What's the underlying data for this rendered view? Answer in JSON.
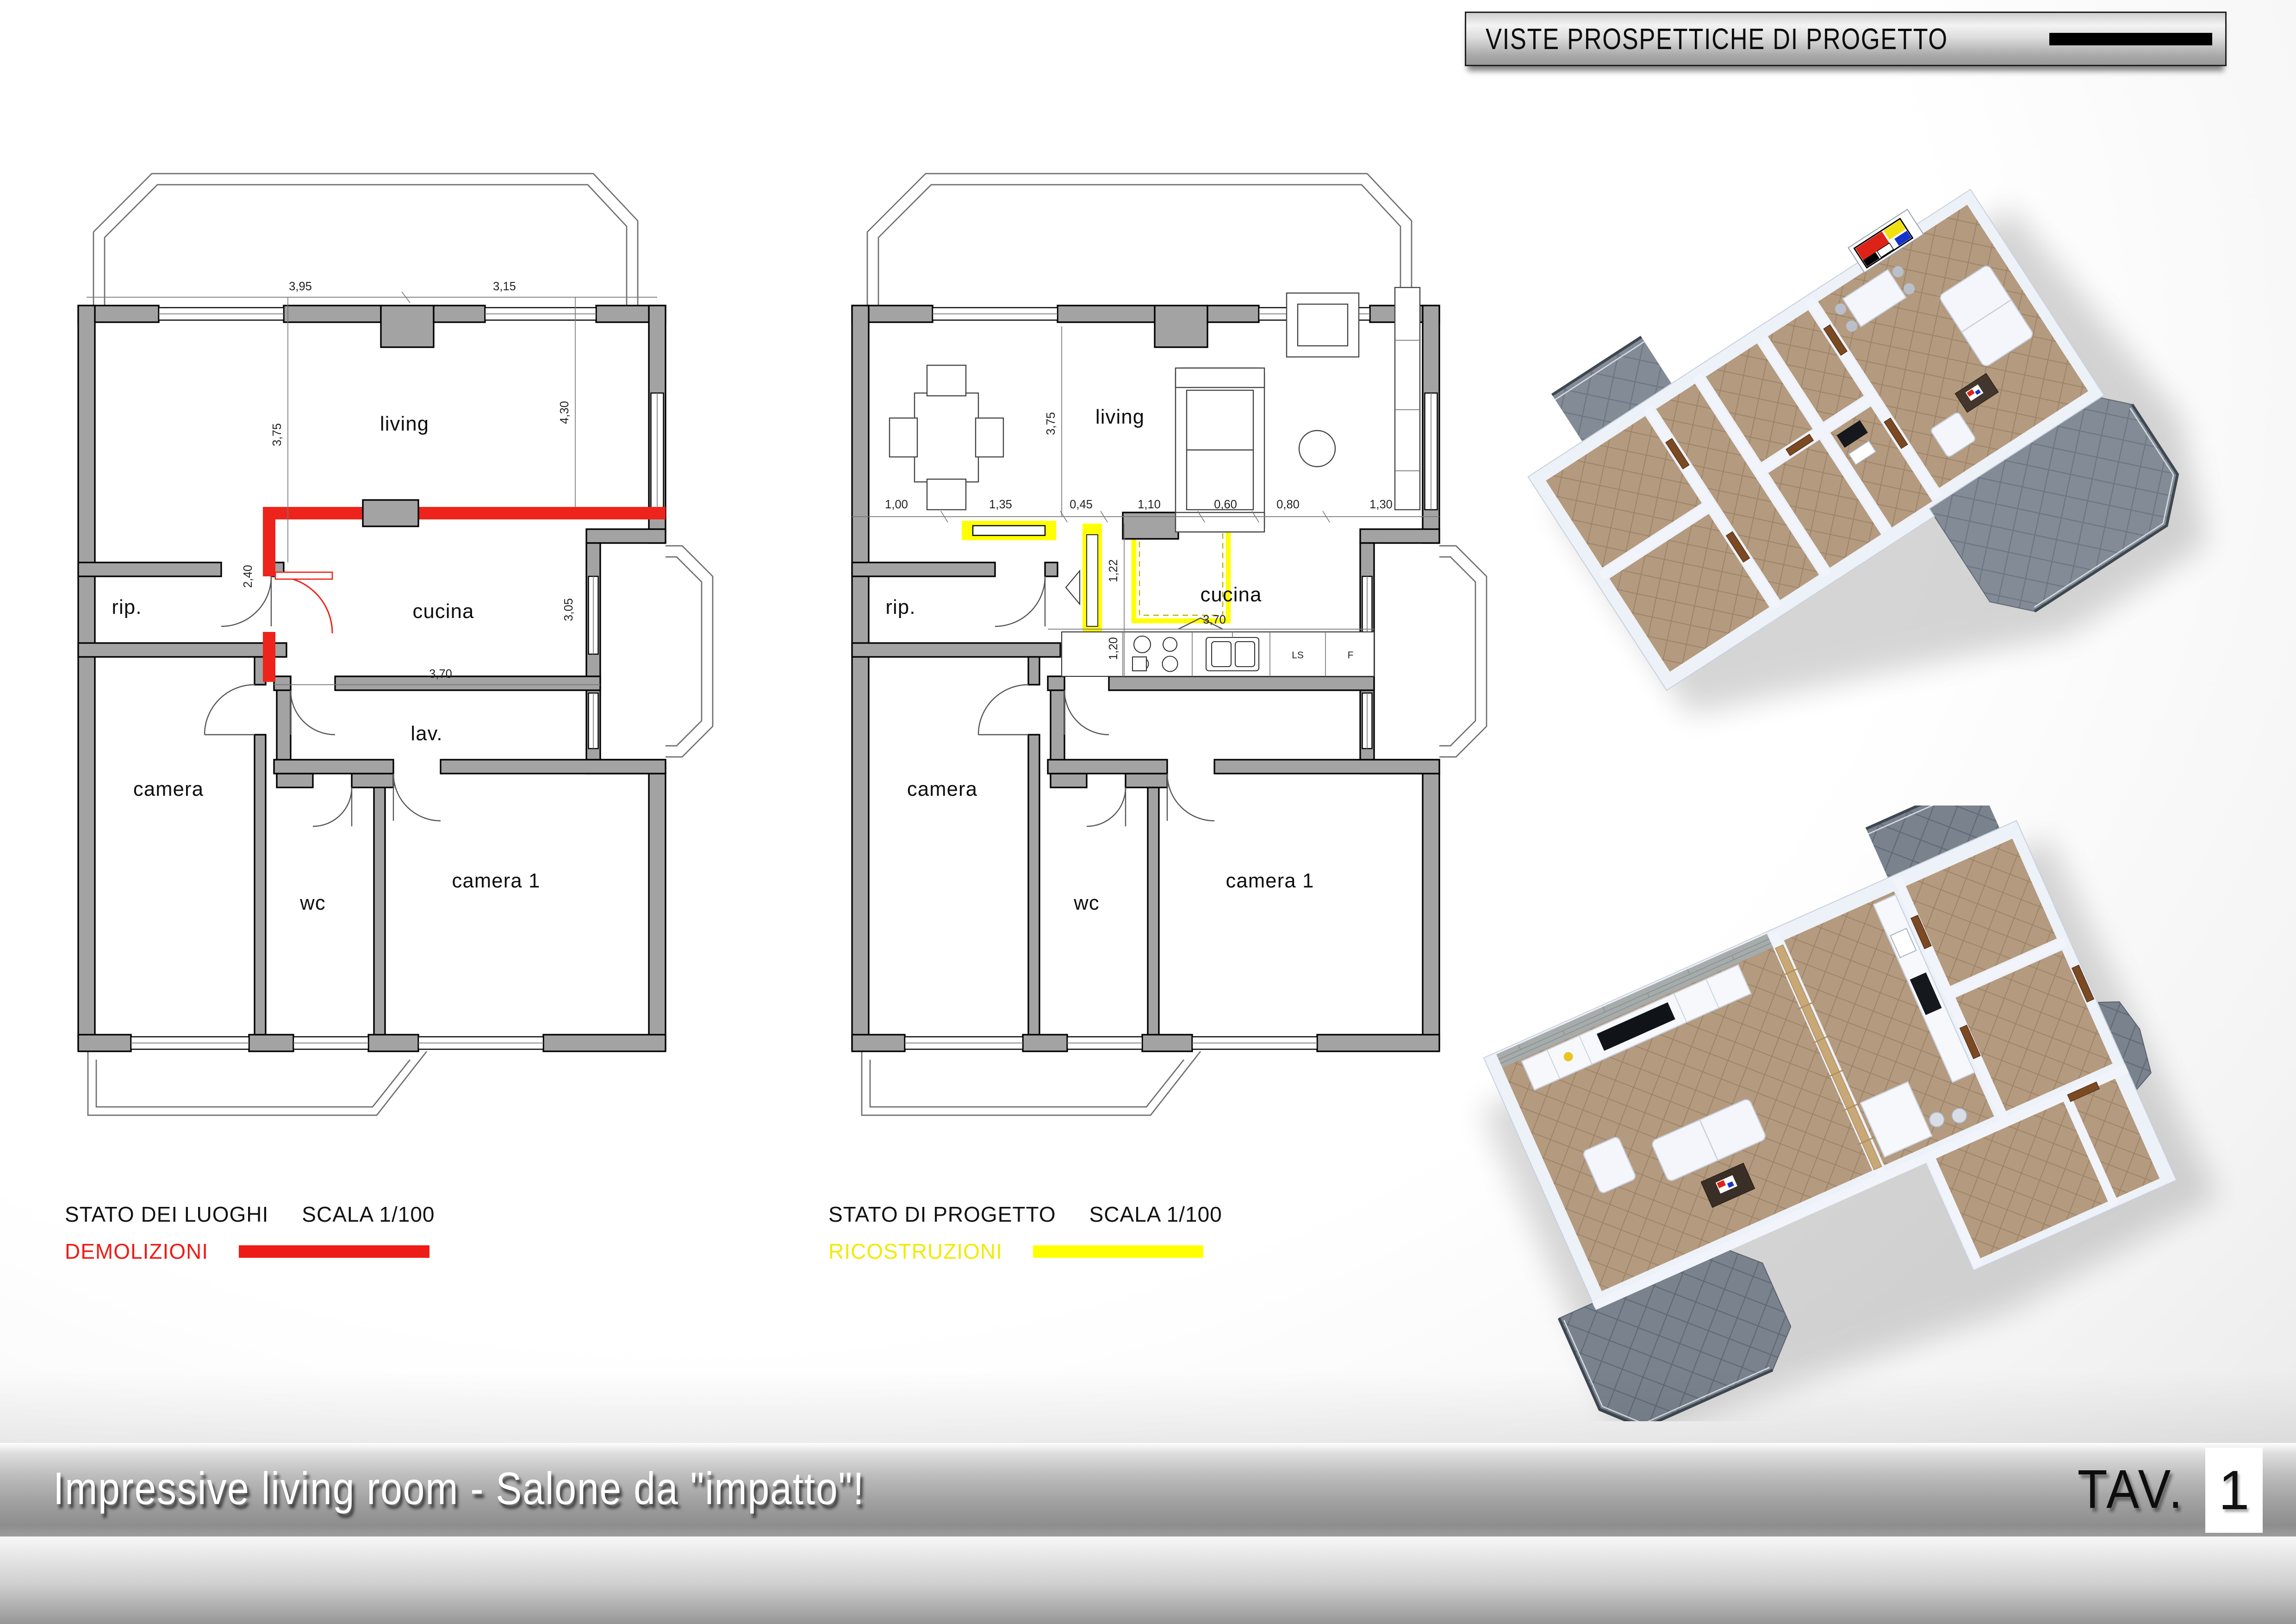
{
  "header": {
    "banner_title": "VISTE PROSPETTICHE DI PROGETTO"
  },
  "plan_left": {
    "rooms": {
      "living": "living",
      "cucina": "cucina",
      "rip": "rip.",
      "camera": "camera",
      "lav": "lav.",
      "wc": "wc",
      "camera1": "camera 1"
    },
    "dims": {
      "top_left": "3,95",
      "top_right": "3,15",
      "left_vert": "3,75",
      "right_vert": "4,30",
      "cucina_left": "2,40",
      "cucina_right": "3,05",
      "cucina_bottom": "3,70"
    },
    "legend": {
      "title": "STATO DEI LUOGHI",
      "scale": "SCALA 1/100",
      "tag": "DEMOLIZIONI",
      "tag_color": "#ee1c16"
    }
  },
  "plan_right": {
    "rooms": {
      "living": "living",
      "cucina": "cucina",
      "rip": "rip.",
      "camera": "camera",
      "wc": "wc",
      "camera1": "camera 1"
    },
    "appliances": {
      "dishwasher": "LS",
      "fridge": "F"
    },
    "dims": {
      "left_vert": "3,75",
      "chain": [
        "1,00",
        "1,35",
        "0,45",
        "1,10",
        "0,60",
        "0,80",
        "1,30"
      ],
      "island_h": "1,22",
      "island_v": "1,20",
      "kitchen_bottom": "3,70"
    },
    "legend": {
      "title": "STATO DI PROGETTO",
      "scale": "SCALA 1/100",
      "tag": "RICOSTRUZIONI",
      "tag_color": "#ffff00"
    }
  },
  "views3d": {
    "palette": {
      "floor": "#b49a7f",
      "terrace": "#7f8893",
      "walls": "#edf1f8",
      "door": "#7c4a22"
    },
    "mondrian_colors": [
      "#dd2218",
      "#f0e011",
      "#1633cc",
      "#000000",
      "#ffffff"
    ]
  },
  "footer": {
    "title": "Impressive living room - Salone da \"impatto\"!",
    "tav_label": "TAV.",
    "tav_number": "1"
  }
}
